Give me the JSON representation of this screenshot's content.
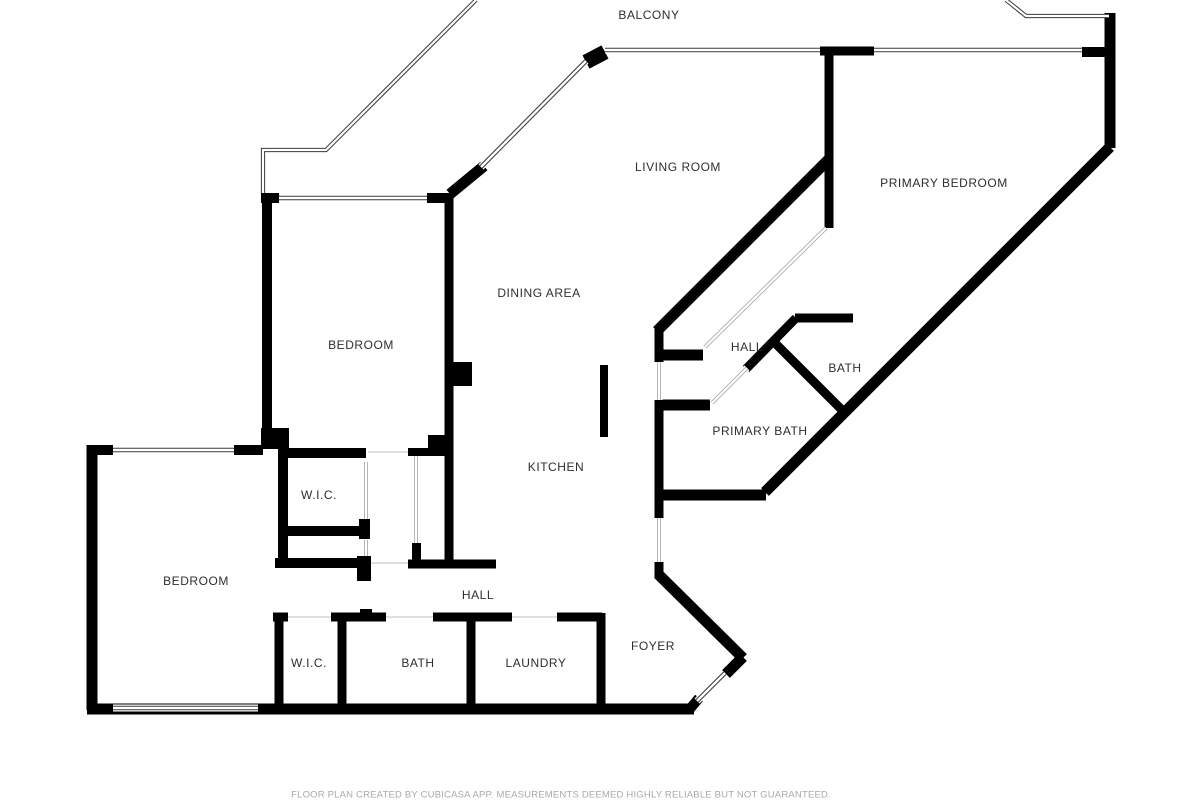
{
  "footer": {
    "disclaimer": "FLOOR PLAN CREATED BY CUBICASA APP. MEASUREMENTS DEEMED HIGHLY RELIABLE BUT NOT GUARANTEED."
  },
  "colors": {
    "background": "#ffffff",
    "wall": "#000000",
    "window_line": "#3a3a3a",
    "light_line": "#adadad",
    "door_line": "#cccccc",
    "label": "#2e2e2e",
    "footer": "#a9a9a9"
  },
  "rooms": [
    {
      "label": "BALCONY",
      "x": 649,
      "y": 15
    },
    {
      "label": "LIVING ROOM",
      "x": 678,
      "y": 167
    },
    {
      "label": "PRIMARY BEDROOM",
      "x": 944,
      "y": 183
    },
    {
      "label": "DINING AREA",
      "x": 539,
      "y": 293
    },
    {
      "label": "BEDROOM",
      "x": 361,
      "y": 345
    },
    {
      "label": "HALL",
      "x": 747,
      "y": 347
    },
    {
      "label": "BATH",
      "x": 845,
      "y": 368
    },
    {
      "label": "PRIMARY BATH",
      "x": 760,
      "y": 431
    },
    {
      "label": "KITCHEN",
      "x": 556,
      "y": 467
    },
    {
      "label": "W.I.C.",
      "x": 319,
      "y": 495
    },
    {
      "label": "BEDROOM",
      "x": 196,
      "y": 581
    },
    {
      "label": "HALL",
      "x": 478,
      "y": 595
    },
    {
      "label": "W.I.C.",
      "x": 309,
      "y": 663
    },
    {
      "label": "BATH",
      "x": 418,
      "y": 663
    },
    {
      "label": "LAUNDRY",
      "x": 536,
      "y": 663
    },
    {
      "label": "FOYER",
      "x": 653,
      "y": 646
    }
  ],
  "floorplan": {
    "walls": [
      [
        261,
        198,
        279,
        198,
        10
      ],
      [
        427,
        198,
        451,
        198,
        10
      ],
      [
        267,
        193,
        267,
        448,
        10
      ],
      [
        449,
        193,
        449,
        563,
        9
      ],
      [
        586,
        62,
        605,
        52,
        15
      ],
      [
        820,
        51,
        874,
        51,
        9
      ],
      [
        1082,
        52,
        1107,
        52,
        10
      ],
      [
        1110,
        13,
        1110,
        148,
        11
      ],
      [
        1110,
        147,
        765,
        492,
        11
      ],
      [
        450,
        194,
        484,
        166,
        11
      ],
      [
        829,
        159,
        657,
        331,
        11
      ],
      [
        829,
        55,
        829,
        228,
        9
      ],
      [
        796,
        318,
        746,
        369,
        9
      ],
      [
        772,
        340,
        845,
        413,
        9
      ],
      [
        795,
        318,
        853,
        318,
        9
      ],
      [
        659,
        327,
        659,
        362,
        9
      ],
      [
        659,
        355,
        703,
        355,
        11
      ],
      [
        659,
        400,
        659,
        496,
        9
      ],
      [
        659,
        405,
        710,
        405,
        11
      ],
      [
        655,
        495,
        766,
        495,
        11
      ],
      [
        659,
        495,
        659,
        518,
        9
      ],
      [
        659,
        562,
        659,
        578,
        9
      ],
      [
        658,
        574,
        743,
        658,
        11
      ],
      [
        743,
        657,
        726,
        674,
        11
      ],
      [
        699,
        698,
        689,
        710,
        10
      ],
      [
        87,
        709,
        694,
        709,
        11
      ],
      [
        92,
        445,
        92,
        710,
        11
      ],
      [
        87,
        450,
        113,
        450,
        10
      ],
      [
        234,
        450,
        263,
        450,
        10
      ],
      [
        278,
        453,
        366,
        453,
        10
      ],
      [
        283,
        448,
        283,
        568,
        10
      ],
      [
        283,
        531,
        367,
        531,
        10
      ],
      [
        275,
        563,
        370,
        563,
        10
      ],
      [
        408,
        452,
        451,
        452,
        8
      ],
      [
        408,
        564,
        496,
        564,
        9
      ],
      [
        273,
        617,
        288,
        617,
        9
      ],
      [
        331,
        617,
        386,
        617,
        9
      ],
      [
        433,
        617,
        512,
        617,
        9
      ],
      [
        557,
        617,
        602,
        617,
        9
      ],
      [
        279,
        613,
        279,
        709,
        9
      ],
      [
        342,
        617,
        342,
        709,
        9
      ],
      [
        471,
        617,
        471,
        709,
        9
      ],
      [
        601,
        613,
        601,
        709,
        9
      ]
    ],
    "rects": [
      [
        261,
        428,
        28,
        21
      ],
      [
        452,
        362,
        20,
        24
      ],
      [
        428,
        435,
        24,
        18
      ],
      [
        600,
        365,
        8,
        72
      ],
      [
        359,
        519,
        11,
        20
      ],
      [
        357,
        556,
        14,
        25
      ],
      [
        412,
        543,
        9,
        25
      ],
      [
        360,
        609,
        12,
        8
      ]
    ],
    "windows": [
      [
        279,
        198,
        427,
        198
      ],
      [
        605,
        50,
        820,
        50
      ],
      [
        874,
        50,
        1082,
        50
      ],
      [
        481,
        167,
        586,
        61
      ],
      [
        113,
        450,
        234,
        450
      ],
      [
        113,
        708,
        258,
        708
      ],
      [
        697,
        701,
        725,
        673
      ]
    ],
    "railings": [
      [
        [
          263,
          193
        ],
        [
          263,
          150
        ],
        [
          326,
          150
        ],
        [
          476,
          0
        ]
      ],
      [
        [
          1006,
          0
        ],
        [
          1026,
          16
        ],
        [
          1109,
          16
        ]
      ]
    ],
    "light_windows": [
      [
        826,
        228,
        705,
        347
      ],
      [
        712,
        403,
        747,
        368
      ],
      [
        416,
        456,
        416,
        543
      ],
      [
        659,
        362,
        659,
        400
      ],
      [
        659,
        518,
        659,
        562
      ],
      [
        366,
        462,
        366,
        519
      ],
      [
        366,
        540,
        366,
        556
      ]
    ],
    "door_lines": [
      [
        368,
        452,
        408,
        452
      ],
      [
        371,
        563,
        408,
        563
      ],
      [
        288,
        617,
        331,
        617
      ],
      [
        386,
        617,
        433,
        617
      ],
      [
        512,
        617,
        557,
        617
      ]
    ]
  }
}
